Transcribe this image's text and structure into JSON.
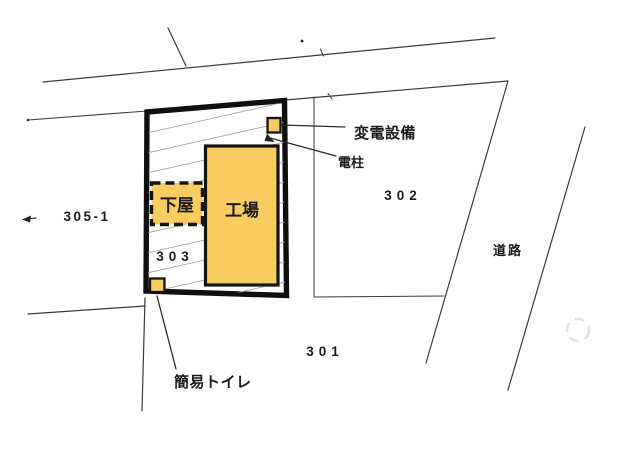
{
  "diagram": {
    "buildings": {
      "factory_label": "工場",
      "lean_to_label": "下屋"
    },
    "parcels": {
      "p305_1_label": "305-1",
      "p303_label": "303",
      "p302_label": "302",
      "p301_label": "301"
    },
    "road_label": "道路",
    "annotations": {
      "substation_label": "変電設備",
      "utility_pole_label": "電柱",
      "portable_toilet_label": "簡易トイレ"
    },
    "colors": {
      "building_fill": "#f8cc61",
      "building_stroke": "#141414",
      "plot_border": "#0f0f0f",
      "boundary_line": "#3a3a3a",
      "hatch_line": "#aaaaaa",
      "background": "#ffffff",
      "text_color": "#1a1a1a"
    }
  }
}
